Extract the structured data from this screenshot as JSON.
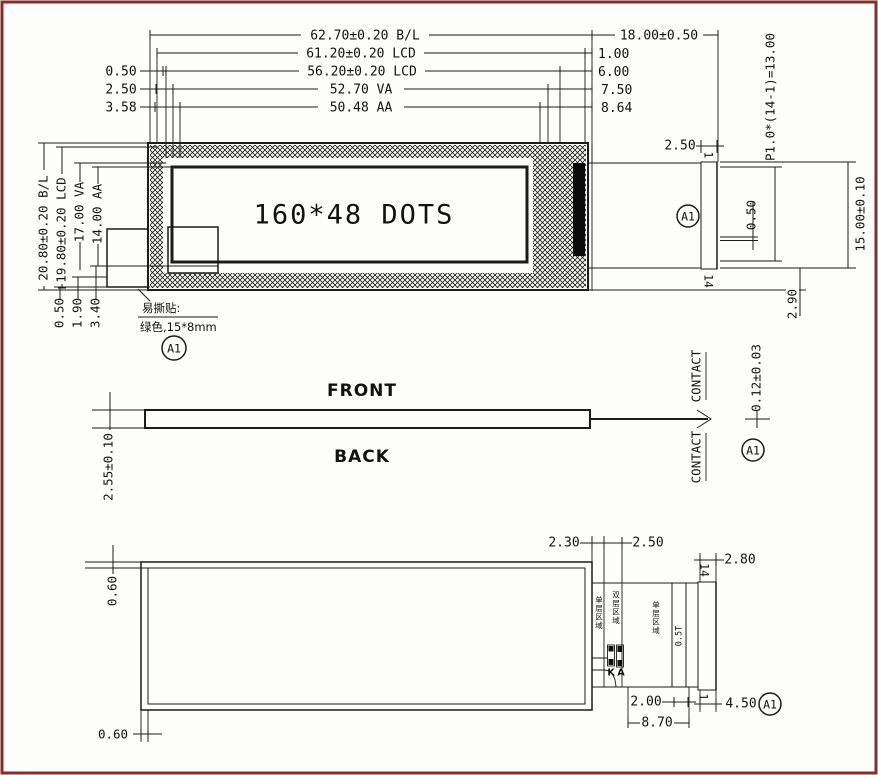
{
  "drawing": {
    "top": {
      "dim_bl": "62.70±0.20 B/L",
      "dim_lcd_outer": "61.20±0.20 LCD",
      "dim_lcd_inner": "56.20±0.20 LCD",
      "dim_va": "52.70 VA",
      "dim_aa": "50.48 AA",
      "off_left_1": "0.50",
      "off_left_2": "2.50",
      "off_left_3": "3.58",
      "off_right_1": "1.00",
      "off_right_2": "6.00",
      "off_right_3": "7.50",
      "off_right_4": "8.64",
      "dim_fpc_len": "18.00±0.50",
      "dim_contact_w": "2.50",
      "pin_first": "1",
      "pin_last": "14",
      "dim_pitch": "P1.0*(14-1)=13.00",
      "dim_contact_gap": "0.50",
      "dim_contact_h": "15.00±0.10",
      "dim_tail_off": "2.90",
      "dim_v_bl": "20.80±0.20 B/L",
      "dim_v_lcd": "19.80±0.20 LCD",
      "dim_v_va": "17.00 VA",
      "dim_v_aa": "14.00 AA",
      "off_bot_1": "0.50",
      "off_bot_2": "1.90",
      "off_bot_3": "3.40",
      "dots_label": "160*48 DOTS",
      "sticker_title": "易撕贴:",
      "sticker_spec": "绿色,15*8mm",
      "detail_ref": "A1"
    },
    "side": {
      "front_label": "FRONT",
      "back_label": "BACK",
      "dim_thickness": "2.55±0.10",
      "contact_top": "CONTACT",
      "contact_bottom": "CONTACT",
      "dim_contact_th": "0.12±0.03",
      "detail_ref": "A1"
    },
    "back": {
      "off_top": "0.60",
      "off_bottom": "0.60",
      "dim_gap1": "2.30",
      "dim_gap2": "2.50",
      "pin_last": "14",
      "dim_comb_w": "2.80",
      "area_single_a": "单层区域",
      "area_double": "双层区域",
      "area_single_b": "单层区域",
      "stiffener": "0.5T",
      "led_k": "K",
      "led_a": "A",
      "dim_stiff": "2.00",
      "dim_tail_len": "8.70",
      "pin_first": "1",
      "dim_end": "4.50",
      "detail_ref": "A1"
    }
  }
}
